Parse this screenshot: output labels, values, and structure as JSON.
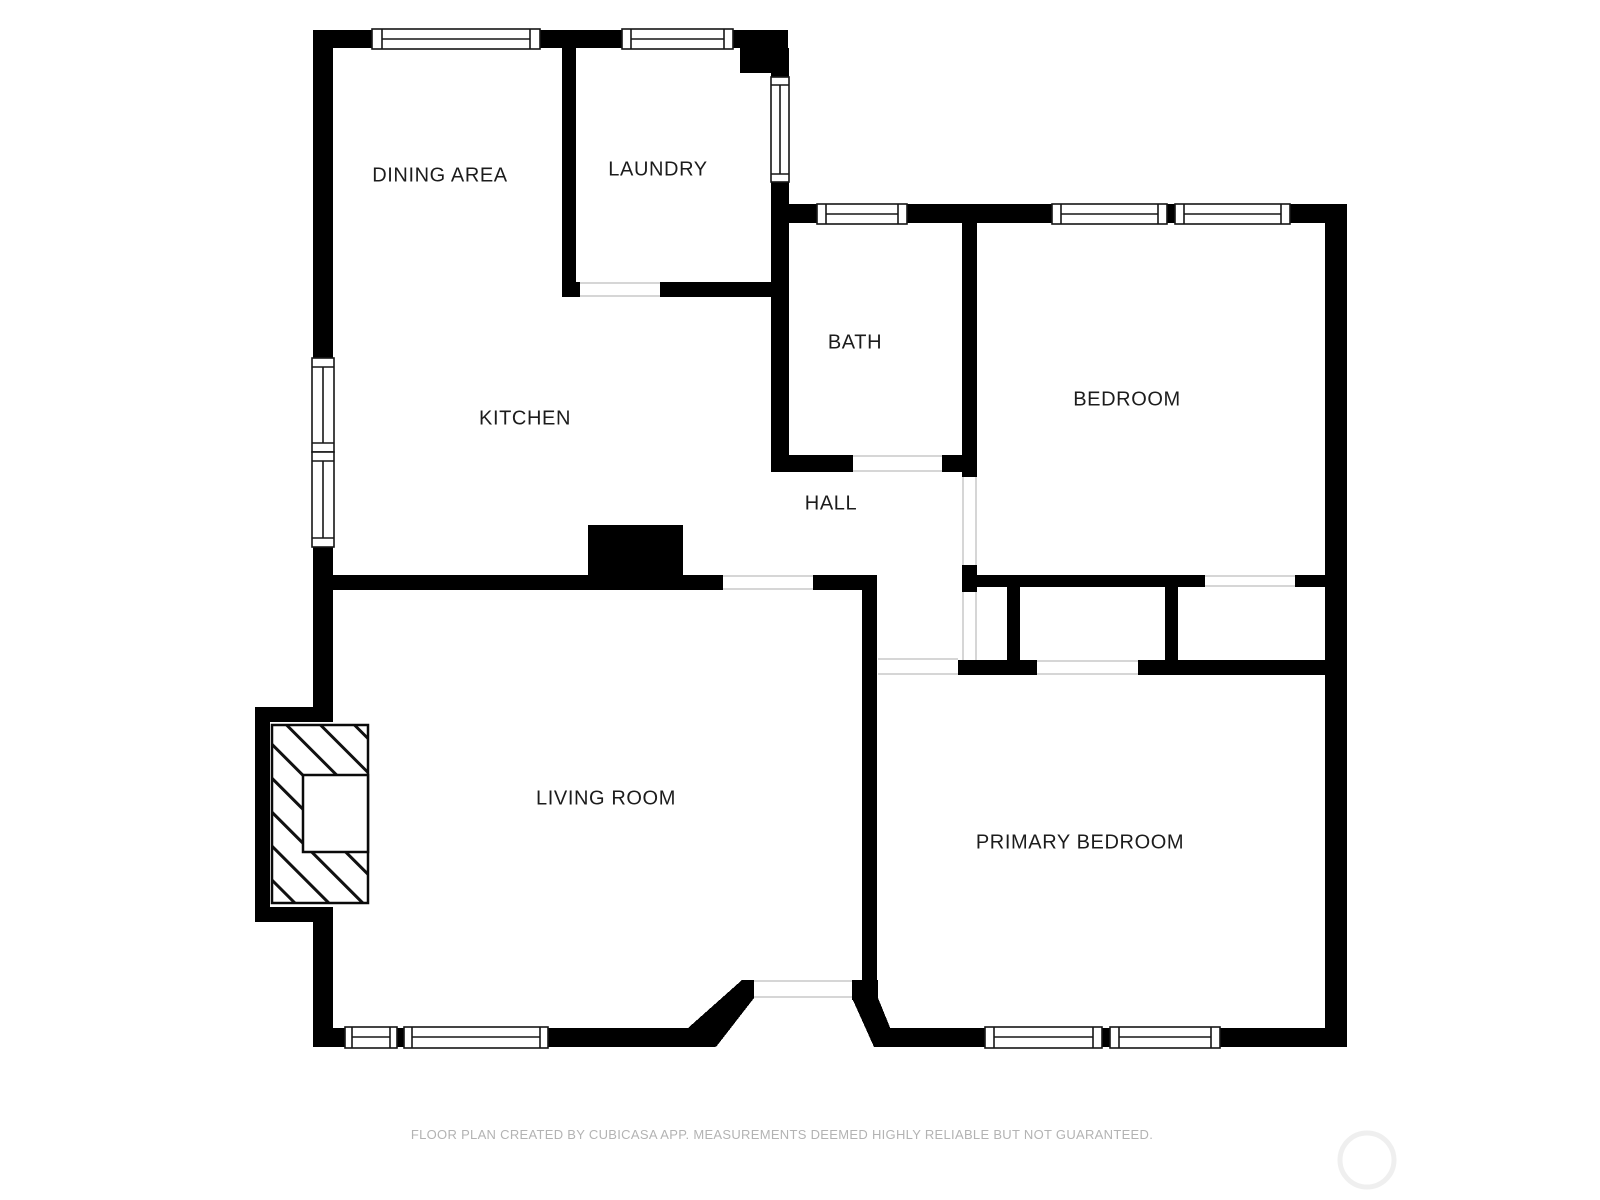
{
  "document": {
    "type": "floor-plan",
    "creator_note": "FLOOR PLAN CREATED BY CUBICASA APP. MEASUREMENTS DEEMED HIGHLY RELIABLE BUT NOT GUARANTEED."
  },
  "rooms": [
    {
      "id": "dining-area",
      "label": "DINING AREA"
    },
    {
      "id": "laundry",
      "label": "LAUNDRY"
    },
    {
      "id": "bath",
      "label": "BATH"
    },
    {
      "id": "bedroom",
      "label": "BEDROOM"
    },
    {
      "id": "kitchen",
      "label": "KITCHEN"
    },
    {
      "id": "hall",
      "label": "HALL"
    },
    {
      "id": "living-room",
      "label": "LIVING ROOM"
    },
    {
      "id": "primary-bedroom",
      "label": "PRIMARY BEDROOM"
    }
  ],
  "features": {
    "windows": [
      "dining-north",
      "laundry-north",
      "laundry-east",
      "kitchen-west-upper",
      "kitchen-west-lower",
      "bath-north",
      "bedroom-north-left",
      "bedroom-north-right",
      "living-south-left",
      "living-south-right",
      "primary-south-left",
      "primary-south-right"
    ],
    "openings": [
      "laundry-door",
      "bath-door",
      "bedroom-door",
      "hall-closet-opening",
      "bedroom-closet-door",
      "primary-closet-door",
      "hall-to-primary-opening",
      "kitchen-to-living-opening",
      "front-door"
    ],
    "fixtures": [
      "fireplace",
      "chimney",
      "kitchen-counter-block"
    ]
  },
  "footer": {
    "disclaimer": "FLOOR PLAN CREATED BY CUBICASA APP. MEASUREMENTS DEEMED HIGHLY RELIABLE BUT NOT GUARANTEED."
  },
  "colors": {
    "wall": "#000000",
    "background": "#ffffff",
    "label_text": "#1c1c1c",
    "footer_text": "#b3b3b3",
    "opening_jamb": "#c9c9c9",
    "window_frame": "#161616",
    "watermark": "#efefef"
  }
}
